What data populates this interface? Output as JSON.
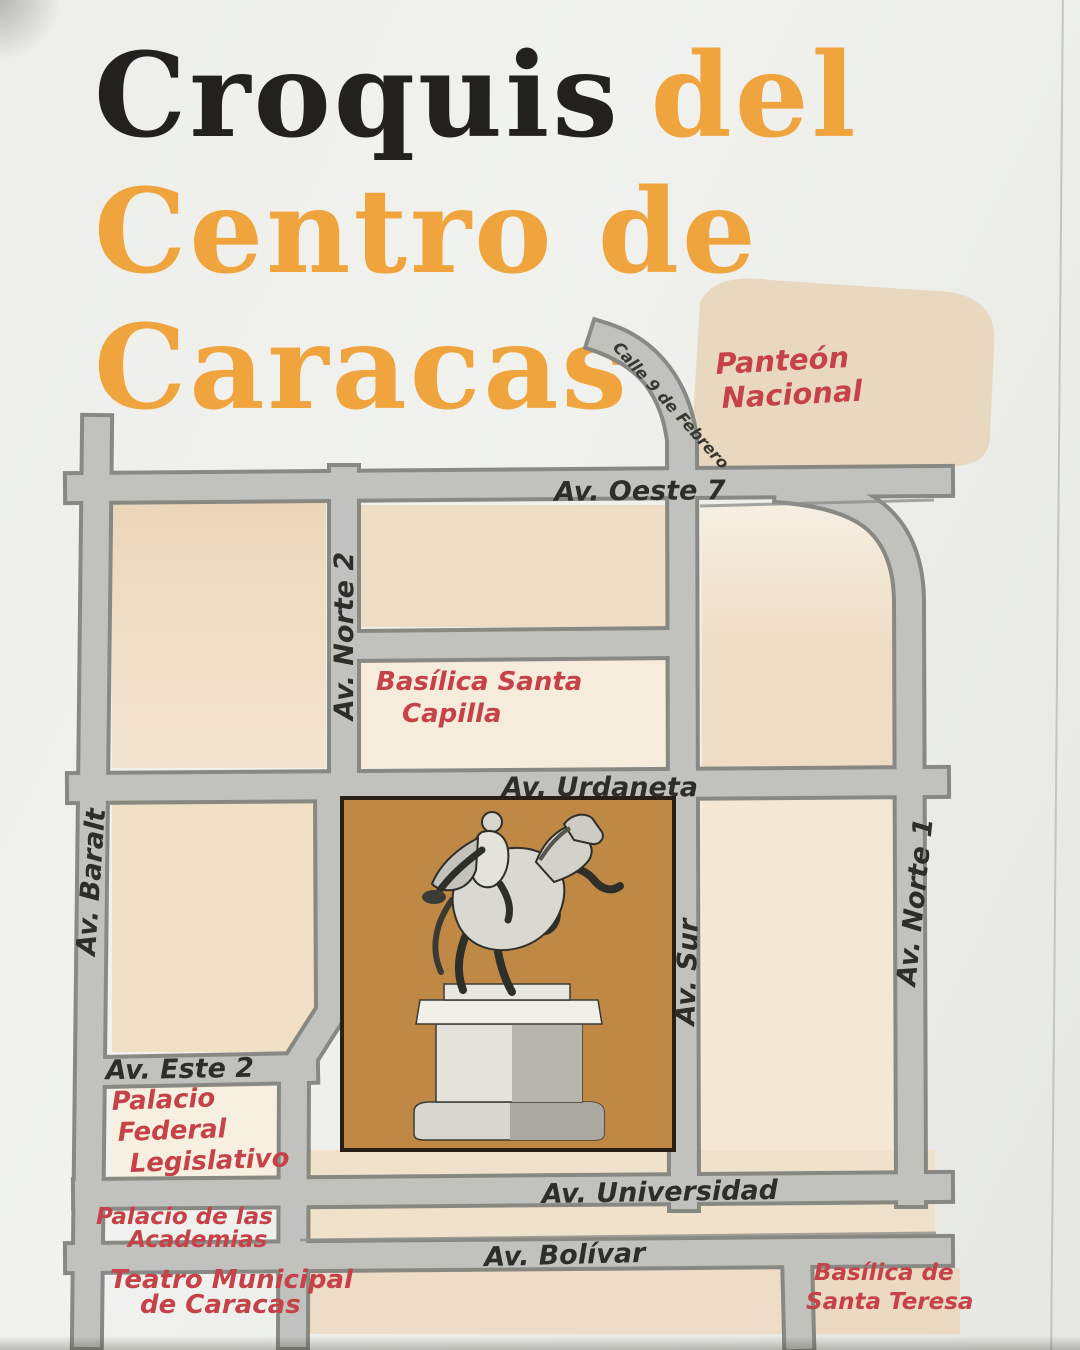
{
  "title": {
    "word_black": "Croquis",
    "word_orange": "del",
    "line2": "Centro de",
    "line3": "Caracas"
  },
  "map": {
    "streets": {
      "oeste7": "Av. Oeste 7",
      "norte2": "Av. Norte 2",
      "baralt": "Av. Baralt",
      "urdaneta": "Av. Urdaneta",
      "norte1": "Av. Norte 1",
      "sur": "Av. Sur",
      "este2": "Av. Este 2",
      "universidad": "Av. Universidad",
      "bolivar": "Av. Bolívar",
      "calle9": "Calle 9 de Febrero"
    },
    "places": {
      "panteon": {
        "l1": "Panteón",
        "l2": "Nacional"
      },
      "capilla": {
        "l1": "Basílica Santa",
        "l2": "Capilla"
      },
      "palacio_federal": {
        "l1": "Palacio",
        "l2": "Federal",
        "l3": "Legislativo"
      },
      "academias": {
        "l1": "Palacio de las",
        "l2": "Academias"
      },
      "teatro": {
        "l1": "Teatro Municipal",
        "l2": "de Caracas"
      },
      "santa_teresa": {
        "l1": "Basílica de",
        "l2": "Santa Teresa"
      }
    },
    "landmark_icon": "bolivar-equestrian-statue",
    "colors": {
      "title_black": "#232120",
      "title_orange": "#efa43d",
      "street_fill": "#c1c2bd",
      "street_edge": "#83847f",
      "block_tan": "#eedcc4",
      "plaza_orange": "#c08845",
      "label_red": "#c44248",
      "ink": "#2e2d29",
      "paper": "#eef0ec"
    }
  }
}
